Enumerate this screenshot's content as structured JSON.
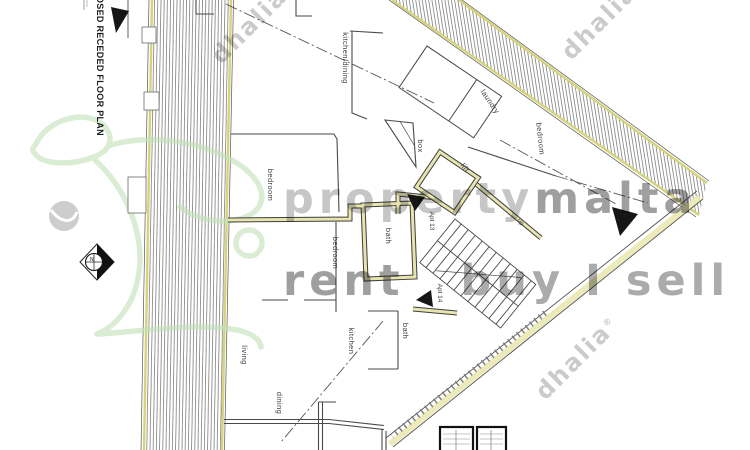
{
  "title_block": {
    "title": "OSED RECEDED FLOOR PLAN"
  },
  "watermarks": {
    "brand_light": "property",
    "brand_bold": "malta",
    "slogan_left": "rent",
    "slogan_right": "buy I sell",
    "agency": "dhalia",
    "agency_mark": "®"
  },
  "compass": {
    "north_label": "N"
  },
  "plan": {
    "rooms": {
      "kitchen_dining": "kitchen/dining",
      "laundry": "laundry",
      "bedroom_top_right": "bedroom",
      "bedroom_top_left": "bedroom",
      "bedroom_middle": "bedroom",
      "box": "box",
      "lift": "lift",
      "bath_upper": "bath",
      "bath_lower": "bath",
      "kitchen": "kitchen",
      "living": "living",
      "dining": "dining"
    },
    "units": {
      "apt_13": "Apt 13",
      "apt_14": "Apt 14"
    },
    "stairs": {
      "direction_label": "up"
    }
  },
  "colors": {
    "wall_accent": "#e7e4ae",
    "band_edge": "#d6d378",
    "line": "#4a4a4a",
    "watermark_gray": "#ababab",
    "logo_green": "#c3e2b8"
  }
}
